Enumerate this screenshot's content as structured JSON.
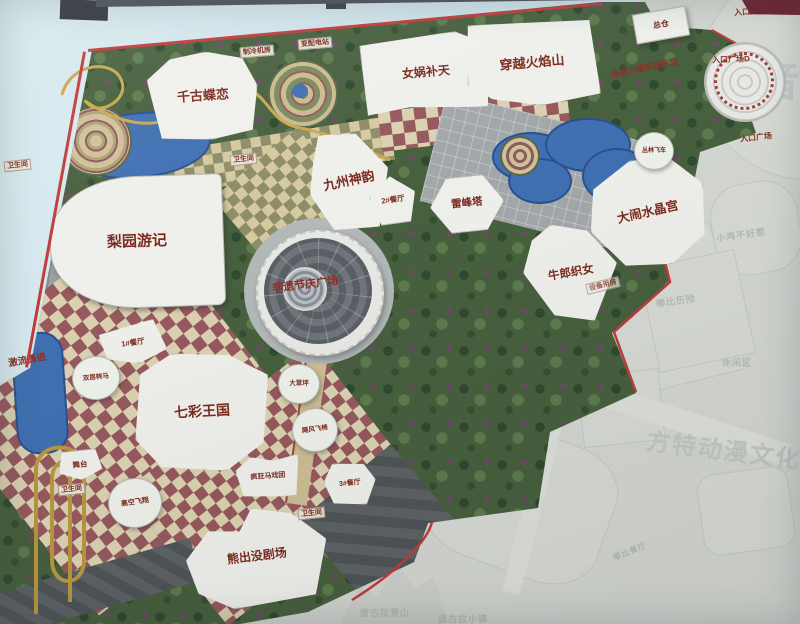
{
  "map": {
    "attractions": {
      "qiangu_dielian": "千古蝶恋",
      "nuwa_butian": "女娲补天",
      "chuanyue_huoyanshan": "穿越火焰山",
      "jiuzhou_shenyun": "九州神韵",
      "leifengta": "雷峰塔",
      "danao_shuijinggong": "大闹水晶宫",
      "niulang_zhinv": "牛郎织女",
      "liyuan_youji": "梨园游记",
      "feiyi_plaza": "非遗节庆广场",
      "qicai_wangguo": "七彩王国",
      "xiongchumo_juchang": "熊出没剧场",
      "jiliu_yongjin": "激流勇进",
      "shuangceng_zhuanma": "双层转马",
      "gaokong_feixiang": "高空飞翔",
      "jufeng_feiyi": "飓风飞椅",
      "fengkuang_maxituan": "疯狂马戏团",
      "dacaoping": "大草坪",
      "wutai": "舞台",
      "conglin_feiche": "丛林飞车",
      "zongcang": "总仓"
    },
    "facilities": {
      "restaurant1": "1#餐厅",
      "restaurant2": "2#餐厅",
      "restaurant3": "3#餐厅",
      "restroom": "卫生间",
      "cooling_plant": "制冷机房",
      "substation": "变配电站",
      "equipment_room": "设备用房"
    },
    "entrances": {
      "plaza_d": "入口广场D",
      "plaza_e": "入口广场E",
      "plaza_main": "入口广场",
      "feiyi_town": "非遗小镇和展示馆"
    },
    "faded_labels": {
      "mofa_chengbao": "魔法城堡",
      "xiaoji_buhaore": "小鸡不好惹",
      "dubi_lixian": "嘟比历险",
      "dubi_canting": "嘟比餐厅",
      "xiuxianqu": "休闲区",
      "tanggula_xueshan": "唐古拉雪山",
      "tanggula_xiaozhen": "唐古拉小镇",
      "jifang2": "2#机房",
      "chuwujian": "储物间",
      "chaoji_dashuiche": "超级大水车"
    },
    "watermarks": {
      "brand": "方特动漫文化科技",
      "big_char": "音"
    },
    "colors": {
      "border_red": "#c03c3c",
      "label_red": "#7d2b20",
      "water_blue": "#4070b2",
      "forest_green": "#47603e"
    }
  }
}
